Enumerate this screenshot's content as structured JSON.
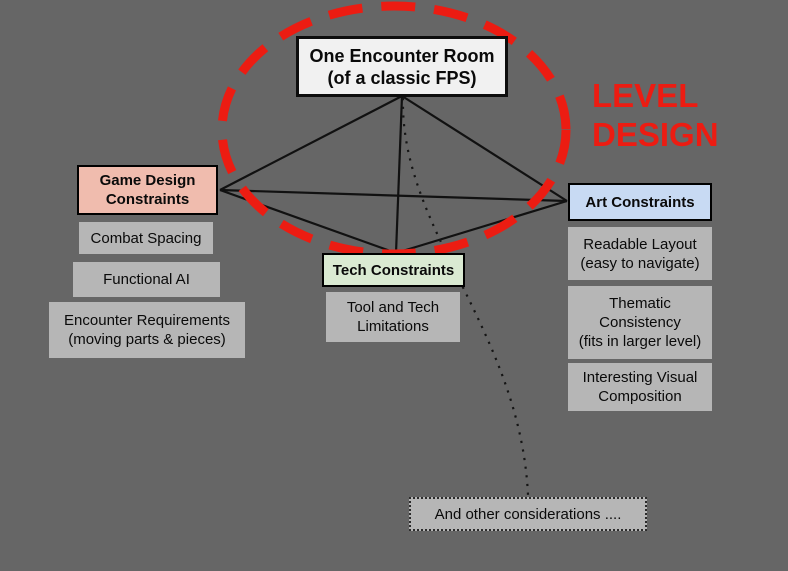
{
  "slide": {
    "background_color": "#666666",
    "annotation": {
      "text": "LEVEL\nDESIGN",
      "color": "#ec1c12"
    },
    "ellipse": {
      "meaning": "level-design-scope",
      "stroke_color": "#ec1c12",
      "style": "dashed"
    },
    "center_node": {
      "text": "One Encounter Room\n(of a classic FPS)",
      "fill": "#f1f1f1"
    },
    "groups": {
      "game_design": {
        "header": "Game Design\nConstraints",
        "header_fill": "#f0bcae",
        "items": [
          "Combat Spacing",
          "Functional AI",
          "Encounter Requirements\n(moving parts & pieces)"
        ]
      },
      "tech": {
        "header": "Tech Constraints",
        "header_fill": "#daead2",
        "items": [
          "Tool and Tech\nLimitations"
        ]
      },
      "art": {
        "header": "Art Constraints",
        "header_fill": "#c8daf3",
        "items": [
          "Readable Layout\n(easy to navigate)",
          "Thematic\nConsistency\n(fits in larger level)",
          "Interesting Visual\nComposition"
        ]
      }
    },
    "other_node": {
      "text": "And other considerations ....",
      "border_style": "dotted"
    },
    "item_fill": "#b6b6b6",
    "line_color": "#111111"
  }
}
